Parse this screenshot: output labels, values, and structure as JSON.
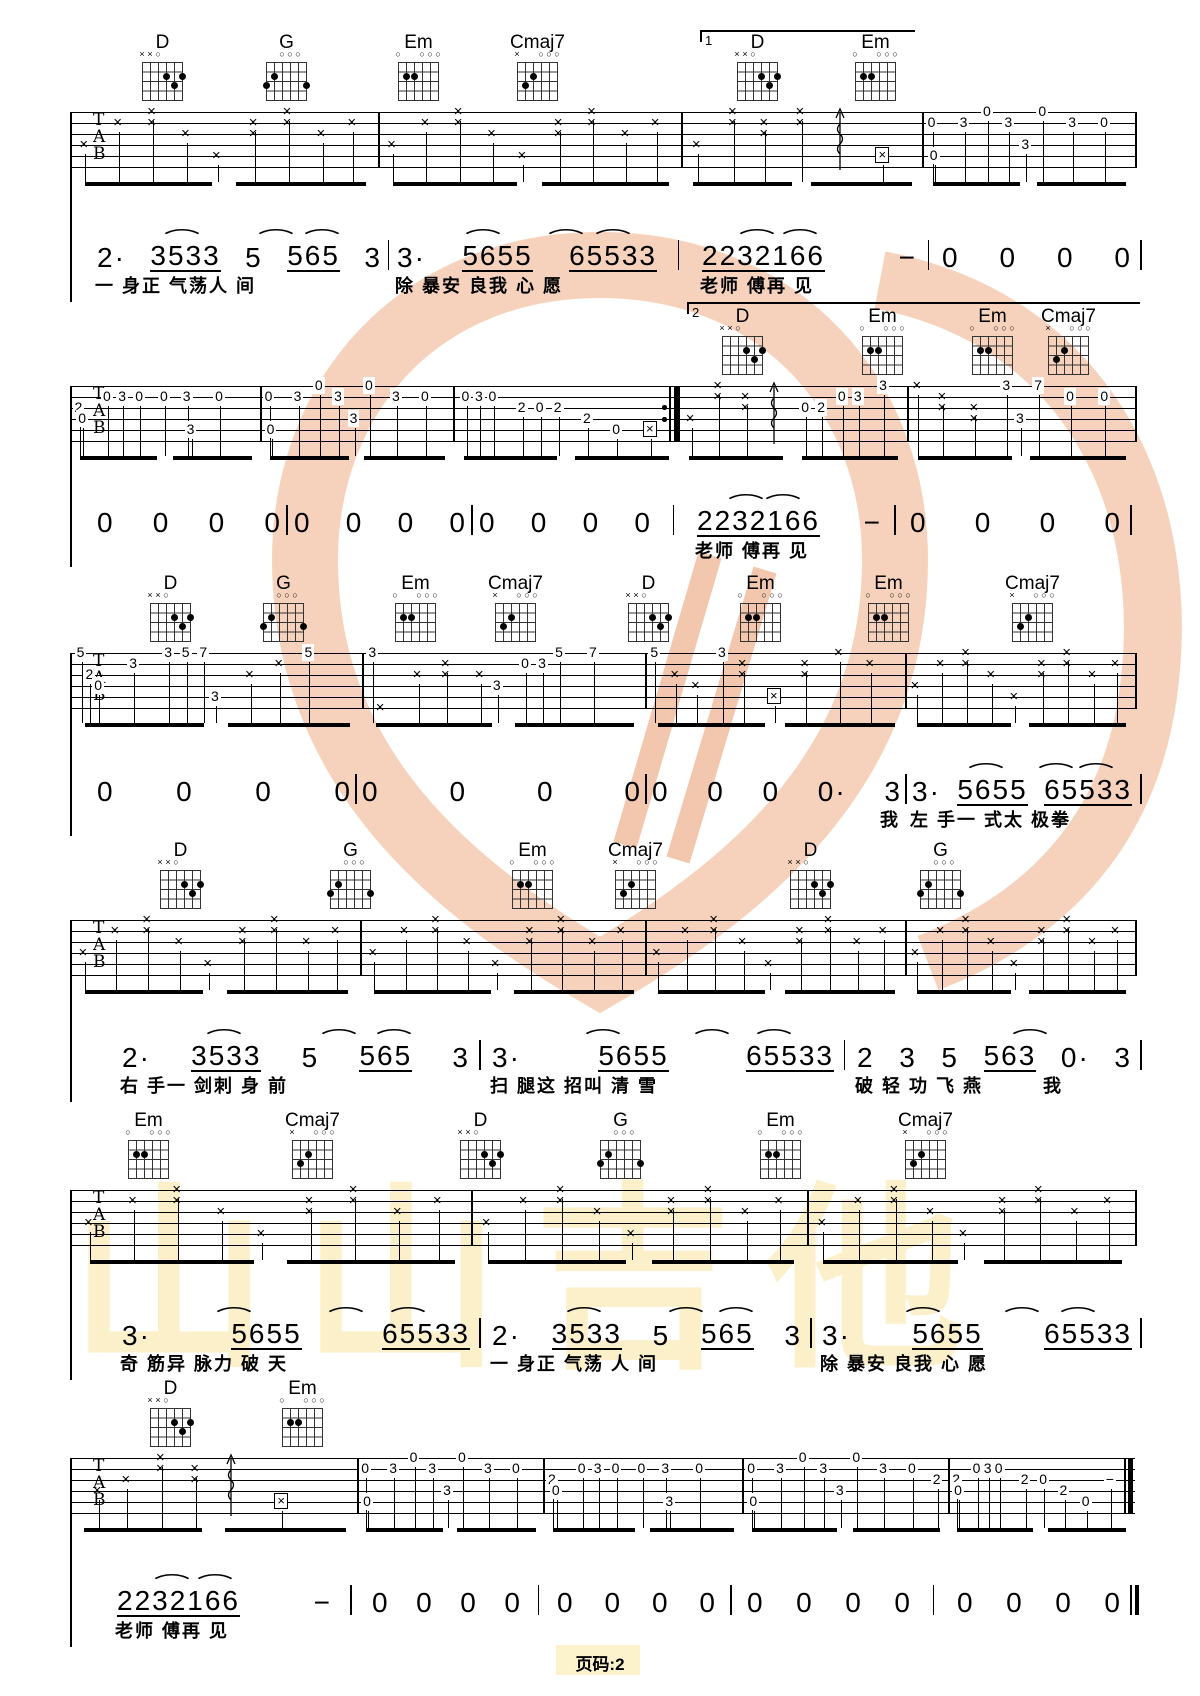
{
  "page": {
    "footer": "页码:2",
    "bg": "#ffffff",
    "ink": "#000000",
    "watermark_peach": "#f5c9ae",
    "watermark_yellow": "#fbf0c9"
  },
  "watermark": {
    "text": "山山吉他"
  },
  "tab_letters": [
    "T",
    "A",
    "B"
  ],
  "chord_shapes": {
    "D": {
      "markers": [
        "×",
        "×",
        "○",
        "",
        "",
        ""
      ],
      "dots": [
        [
          4,
          2
        ],
        [
          6,
          2
        ],
        [
          5,
          3
        ]
      ]
    },
    "G": {
      "markers": [
        "",
        "",
        "○",
        "○",
        "○",
        ""
      ],
      "dots": [
        [
          2,
          2
        ],
        [
          1,
          3
        ],
        [
          6,
          3
        ]
      ]
    },
    "Em": {
      "markers": [
        "○",
        "",
        "",
        "○",
        "○",
        "○"
      ],
      "dots": [
        [
          2,
          2
        ],
        [
          3,
          2
        ]
      ]
    },
    "Cmaj7": {
      "markers": [
        "×",
        "",
        "",
        "○",
        "○",
        "○"
      ],
      "dots": [
        [
          3,
          2
        ],
        [
          2,
          3
        ]
      ]
    }
  },
  "patterns": {
    "strum": [
      [
        0.05,
        3,
        "x"
      ],
      [
        0.16,
        1,
        "x"
      ],
      [
        0.27,
        0,
        "x"
      ],
      [
        0.27,
        1,
        "x"
      ],
      [
        0.38,
        2,
        "x"
      ],
      [
        0.48,
        4,
        "x"
      ],
      [
        0.6,
        1,
        "x"
      ],
      [
        0.6,
        2,
        "x"
      ],
      [
        0.71,
        0,
        "x"
      ],
      [
        0.71,
        1,
        "x"
      ],
      [
        0.82,
        2,
        "x"
      ],
      [
        0.92,
        1,
        "x"
      ]
    ],
    "strumArp": [
      [
        0.07,
        3,
        "x"
      ],
      [
        0.22,
        0,
        "x"
      ],
      [
        0.22,
        1,
        "x"
      ],
      [
        0.35,
        1,
        "x"
      ],
      [
        0.35,
        2,
        "x"
      ],
      [
        0.5,
        0,
        "x"
      ],
      [
        0.5,
        1,
        "x"
      ],
      [
        0.66,
        -1,
        "arp"
      ],
      [
        0.84,
        4,
        "bx"
      ]
    ],
    "strumArpB": [
      [
        0.06,
        3,
        "x"
      ],
      [
        0.18,
        0,
        "x"
      ],
      [
        0.18,
        1,
        "x"
      ],
      [
        0.3,
        1,
        "x"
      ],
      [
        0.3,
        2,
        "x"
      ],
      [
        0.42,
        -1,
        "arp"
      ],
      [
        0.56,
        2,
        "0"
      ],
      [
        0.63,
        2,
        "2"
      ],
      [
        0.72,
        1,
        "0"
      ],
      [
        0.79,
        1,
        "3"
      ],
      [
        0.9,
        0,
        "3"
      ]
    ],
    "strumArpC": [
      [
        0.1,
        3,
        "x"
      ],
      [
        0.2,
        2,
        "x"
      ],
      [
        0.32,
        0,
        "x"
      ],
      [
        0.32,
        1,
        "x"
      ],
      [
        0.44,
        1,
        "x"
      ],
      [
        0.44,
        2,
        "x"
      ],
      [
        0.56,
        -1,
        "arp"
      ],
      [
        0.74,
        4,
        "bx"
      ]
    ],
    "pickA": [
      [
        0.05,
        1,
        "0"
      ],
      [
        0.06,
        4,
        "0"
      ],
      [
        0.2,
        1,
        "3"
      ],
      [
        0.31,
        0,
        "0"
      ],
      [
        0.41,
        1,
        "3"
      ],
      [
        0.49,
        3,
        "3"
      ],
      [
        0.57,
        0,
        "0"
      ],
      [
        0.71,
        1,
        "3"
      ],
      [
        0.86,
        1,
        "0"
      ]
    ],
    "pickA2": [
      [
        0.05,
        1,
        "0"
      ],
      [
        0.06,
        4,
        "0"
      ],
      [
        0.19,
        1,
        "3"
      ],
      [
        0.3,
        0,
        "0"
      ],
      [
        0.4,
        1,
        "3"
      ],
      [
        0.48,
        3,
        "3"
      ],
      [
        0.56,
        0,
        "0"
      ],
      [
        0.69,
        1,
        "3"
      ],
      [
        0.83,
        1,
        "0"
      ],
      [
        0.95,
        2,
        "2"
      ]
    ],
    "pickB": [
      [
        0.05,
        2,
        "2"
      ],
      [
        0.07,
        3,
        "0"
      ],
      [
        0.2,
        1,
        "0"
      ],
      [
        0.28,
        1,
        "3"
      ],
      [
        0.37,
        1,
        "0"
      ],
      [
        0.5,
        1,
        "0"
      ],
      [
        0.62,
        1,
        "3"
      ],
      [
        0.64,
        4,
        "3"
      ],
      [
        0.79,
        1,
        "0"
      ]
    ],
    "pickC": [
      [
        0.06,
        1,
        "0"
      ],
      [
        0.12,
        1,
        "3"
      ],
      [
        0.18,
        1,
        "0"
      ],
      [
        0.31,
        2,
        "2"
      ],
      [
        0.39,
        2,
        "0"
      ],
      [
        0.47,
        2,
        "2"
      ],
      [
        0.6,
        3,
        "2"
      ],
      [
        0.73,
        4,
        "0"
      ],
      [
        0.88,
        4,
        "bx"
      ]
    ],
    "pickE": [
      [
        0.05,
        0,
        "x"
      ],
      [
        0.16,
        1,
        "x"
      ],
      [
        0.16,
        2,
        "x"
      ],
      [
        0.3,
        2,
        "x"
      ],
      [
        0.3,
        3,
        "x"
      ],
      [
        0.44,
        0,
        "3"
      ],
      [
        0.5,
        3,
        "3"
      ],
      [
        0.58,
        0,
        "7"
      ],
      [
        0.72,
        1,
        "0"
      ],
      [
        0.87,
        1,
        "0"
      ]
    ],
    "pickF": [
      [
        0.04,
        0,
        "5"
      ],
      [
        0.07,
        2,
        "2"
      ],
      [
        0.1,
        3,
        "0"
      ],
      [
        0.22,
        1,
        "3"
      ],
      [
        0.34,
        0,
        "3"
      ],
      [
        0.4,
        0,
        "5"
      ],
      [
        0.46,
        0,
        "7"
      ],
      [
        0.5,
        4,
        "3"
      ],
      [
        0.62,
        2,
        "x"
      ],
      [
        0.72,
        1,
        "x"
      ],
      [
        0.82,
        0,
        "5"
      ]
    ],
    "pickG": [
      [
        0.04,
        0,
        "3"
      ],
      [
        0.07,
        5,
        "x"
      ],
      [
        0.2,
        2,
        "x"
      ],
      [
        0.3,
        1,
        "x"
      ],
      [
        0.3,
        2,
        "x"
      ],
      [
        0.42,
        2,
        "x"
      ],
      [
        0.48,
        3,
        "3"
      ],
      [
        0.58,
        1,
        "0"
      ],
      [
        0.64,
        1,
        "3"
      ],
      [
        0.7,
        0,
        "5"
      ],
      [
        0.82,
        0,
        "7"
      ]
    ],
    "pickH": [
      [
        0.04,
        0,
        "5"
      ],
      [
        0.12,
        2,
        "x"
      ],
      [
        0.2,
        3,
        "x"
      ],
      [
        0.3,
        0,
        "3"
      ],
      [
        0.38,
        1,
        "x"
      ],
      [
        0.38,
        2,
        "x"
      ],
      [
        0.5,
        4,
        "bx"
      ],
      [
        0.62,
        1,
        "x"
      ],
      [
        0.62,
        2,
        "x"
      ],
      [
        0.75,
        0,
        "x"
      ],
      [
        0.87,
        1,
        "x"
      ]
    ],
    "pickEnd": [
      [
        0.05,
        2,
        "2"
      ],
      [
        0.06,
        3,
        "0"
      ],
      [
        0.16,
        1,
        "0"
      ],
      [
        0.22,
        1,
        "3"
      ],
      [
        0.28,
        1,
        "0"
      ],
      [
        0.42,
        2,
        "2"
      ],
      [
        0.52,
        2,
        "0"
      ],
      [
        0.63,
        3,
        "2"
      ],
      [
        0.75,
        4,
        "0"
      ],
      [
        0.88,
        2,
        "−"
      ]
    ]
  },
  "systems": [
    {
      "staff": 112,
      "chords": [
        {
          "n": "D",
          "x": 142
        },
        {
          "n": "G",
          "x": 266
        },
        {
          "n": "Em",
          "x": 398
        },
        {
          "n": "Cmaj7",
          "x": 517
        },
        {
          "n": "D",
          "x": 737
        },
        {
          "n": "Em",
          "x": 855
        }
      ],
      "volta": {
        "label": "1",
        "x1": 700,
        "x2": 915,
        "y": 30
      },
      "measures": [
        {
          "x1": 70,
          "x2": 378,
          "p": "strum"
        },
        {
          "x1": 378,
          "x2": 681,
          "p": "strum"
        },
        {
          "x1": 681,
          "x2": 922,
          "p": "strumArp"
        },
        {
          "x1": 922,
          "x2": 1135,
          "p": "pickA"
        }
      ],
      "jianpu": {
        "y": 238,
        "ly": 272,
        "measures": [
          {
            "x1": 95,
            "x2": 380,
            "nums": "2· 3533 5 565 3",
            "arcs": [
              0.27,
              0.6,
              0.76
            ],
            "lyric": "一 身正 气荡人 间"
          },
          {
            "x1": 395,
            "x2": 655,
            "nums": "3· 5655 65533",
            "arcs": [
              0.3,
              0.62,
              0.8
            ],
            "lyric": "除 暴安 良我 心 愿"
          },
          {
            "x1": 700,
            "x2": 915,
            "nums": "2232166 −",
            "arcs": [
              0.22,
              0.42
            ],
            "lyric": "老师 傅再 见"
          },
          {
            "x1": 940,
            "x2": 1130,
            "nums": "0 0 0 0"
          }
        ]
      }
    },
    {
      "staff": 386,
      "chords": [
        {
          "n": "D",
          "x": 722
        },
        {
          "n": "Em",
          "x": 862
        },
        {
          "n": "Em",
          "x": 972
        },
        {
          "n": "Cmaj7",
          "x": 1048
        }
      ],
      "volta": {
        "label": "2",
        "x1": 687,
        "x2": 1140,
        "y": 302
      },
      "measures": [
        {
          "x1": 70,
          "x2": 260,
          "p": "pickB"
        },
        {
          "x1": 260,
          "x2": 453,
          "p": "pickA"
        },
        {
          "x1": 453,
          "x2": 678,
          "p": "pickC",
          "repeat": true
        },
        {
          "x1": 678,
          "x2": 907,
          "p": "strumArpB"
        },
        {
          "x1": 907,
          "x2": 1135,
          "p": "pickE"
        }
      ],
      "jianpu": {
        "y": 503,
        "ly": 537,
        "measures": [
          {
            "x1": 95,
            "x2": 280,
            "nums": "0 0 0 0"
          },
          {
            "x1": 292,
            "x2": 465,
            "nums": "0 0 0 0"
          },
          {
            "x1": 477,
            "x2": 650,
            "nums": "0 0 0 0"
          },
          {
            "x1": 695,
            "x2": 880,
            "nums": "2232166 −",
            "arcs": [
              0.22,
              0.42
            ],
            "lyric": "老师 傅再 见"
          },
          {
            "x1": 908,
            "x2": 1120,
            "nums": "0 0 0 0"
          }
        ]
      }
    },
    {
      "staff": 653,
      "chords": [
        {
          "n": "D",
          "x": 150
        },
        {
          "n": "G",
          "x": 263
        },
        {
          "n": "Em",
          "x": 395
        },
        {
          "n": "Cmaj7",
          "x": 495
        },
        {
          "n": "D",
          "x": 628
        },
        {
          "n": "Em",
          "x": 740
        },
        {
          "n": "Em",
          "x": 868
        },
        {
          "n": "Cmaj7",
          "x": 1012
        }
      ],
      "measures": [
        {
          "x1": 70,
          "x2": 362,
          "p": "pickF"
        },
        {
          "x1": 362,
          "x2": 645,
          "p": "pickG"
        },
        {
          "x1": 645,
          "x2": 905,
          "p": "pickH"
        },
        {
          "x1": 905,
          "x2": 1135,
          "p": "strum"
        }
      ],
      "jianpu": {
        "y": 772,
        "ly": 806,
        "measures": [
          {
            "x1": 95,
            "x2": 350,
            "nums": "0 0 0 0"
          },
          {
            "x1": 360,
            "x2": 640,
            "nums": "0 0 0 0"
          },
          {
            "x1": 650,
            "x2": 900,
            "nums": "0 0 0 0· 3",
            "lyric": "我",
            "lyA": "right"
          },
          {
            "x1": 910,
            "x2": 1130,
            "nums": "3· 5655 65533",
            "arcs": [
              0.3,
              0.62,
              0.8
            ],
            "lyric": "左 手一 式太 极拳"
          }
        ]
      }
    },
    {
      "staff": 920,
      "chords": [
        {
          "n": "D",
          "x": 160
        },
        {
          "n": "G",
          "x": 330
        },
        {
          "n": "Em",
          "x": 512
        },
        {
          "n": "Cmaj7",
          "x": 615
        },
        {
          "n": "D",
          "x": 790
        },
        {
          "n": "G",
          "x": 920
        }
      ],
      "measures": [
        {
          "x1": 70,
          "x2": 360,
          "p": "strum"
        },
        {
          "x1": 360,
          "x2": 645,
          "p": "strum"
        },
        {
          "x1": 645,
          "x2": 905,
          "p": "strum"
        },
        {
          "x1": 905,
          "x2": 1135,
          "p": "strum"
        }
      ],
      "jianpu": {
        "y": 1038,
        "ly": 1072,
        "measures": [
          {
            "x1": 120,
            "x2": 468,
            "nums": "2· 3533 5 565 3",
            "arcs": [
              0.27,
              0.6,
              0.76
            ],
            "lyric": "右 手一 剑刺 身 前"
          },
          {
            "x1": 490,
            "x2": 832,
            "nums": "3· 5655 65533",
            "arcs": [
              0.3,
              0.62,
              0.8
            ],
            "lyric": "扫 腿这 招叫 清 雪"
          },
          {
            "x1": 855,
            "x2": 1130,
            "nums": "2 3 5 563 0· 3",
            "arcs": [
              0.6
            ],
            "lyric": "破 轻 功 飞 燕　　　我"
          }
        ]
      }
    },
    {
      "staff": 1190,
      "chords": [
        {
          "n": "Em",
          "x": 128
        },
        {
          "n": "Cmaj7",
          "x": 292
        },
        {
          "n": "D",
          "x": 460
        },
        {
          "n": "G",
          "x": 600
        },
        {
          "n": "Em",
          "x": 760
        },
        {
          "n": "Cmaj7",
          "x": 905
        }
      ],
      "measures": [
        {
          "x1": 70,
          "x2": 471,
          "p": "strum"
        },
        {
          "x1": 471,
          "x2": 807,
          "p": "strum"
        },
        {
          "x1": 807,
          "x2": 1135,
          "p": "strum"
        }
      ],
      "jianpu": {
        "y": 1316,
        "ly": 1350,
        "measures": [
          {
            "x1": 120,
            "x2": 468,
            "nums": "3· 5655 65533",
            "arcs": [
              0.3,
              0.62,
              0.8
            ],
            "lyric": "奇 筋异 脉力 破 天"
          },
          {
            "x1": 490,
            "x2": 800,
            "nums": "2· 3533 5 565 3",
            "arcs": [
              0.27,
              0.6,
              0.76
            ],
            "lyric": "一 身正 气荡 人 间"
          },
          {
            "x1": 820,
            "x2": 1130,
            "nums": "3· 5655 65533",
            "arcs": [
              0.3,
              0.62,
              0.8
            ],
            "lyric": "除 暴安 良我 心 愿"
          }
        ]
      }
    },
    {
      "staff": 1458,
      "chords": [
        {
          "n": "D",
          "x": 150
        },
        {
          "n": "Em",
          "x": 282
        }
      ],
      "measures": [
        {
          "x1": 70,
          "x2": 357,
          "p": "strumArpC"
        },
        {
          "x1": 357,
          "x2": 543,
          "p": "pickA"
        },
        {
          "x1": 543,
          "x2": 742,
          "p": "pickB"
        },
        {
          "x1": 742,
          "x2": 948,
          "p": "pickA2"
        },
        {
          "x1": 948,
          "x2": 1133,
          "p": "pickEnd",
          "final": true
        }
      ],
      "jianpu": {
        "y": 1583,
        "ly": 1617,
        "final": true,
        "measures": [
          {
            "x1": 115,
            "x2": 330,
            "nums": "2232166 −",
            "arcs": [
              0.22,
              0.42
            ],
            "lyric": "老师 傅再 见"
          },
          {
            "x1": 370,
            "x2": 520,
            "nums": "0 0 0 0"
          },
          {
            "x1": 555,
            "x2": 715,
            "nums": "0 0 0 0"
          },
          {
            "x1": 745,
            "x2": 910,
            "nums": "0 0 0 0"
          },
          {
            "x1": 955,
            "x2": 1120,
            "nums": "0 0 0 0"
          }
        ]
      }
    }
  ]
}
